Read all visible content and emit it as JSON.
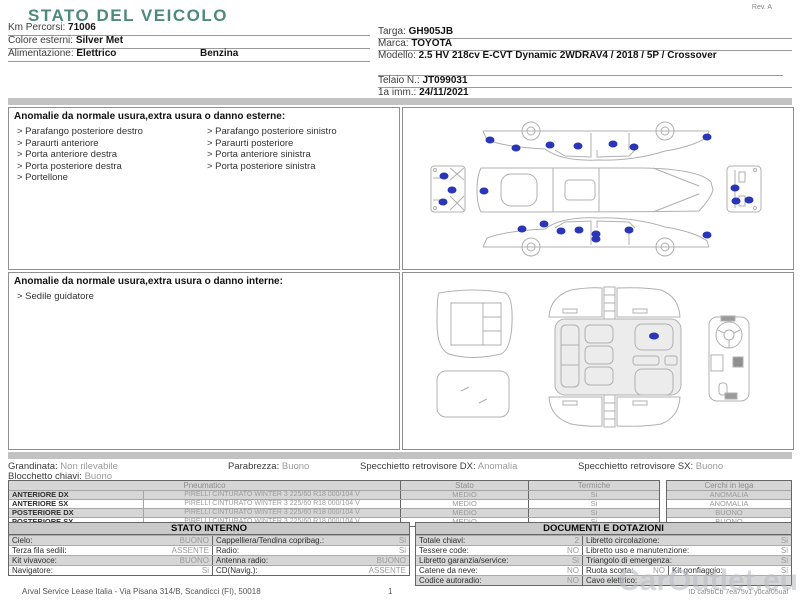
{
  "page": {
    "title": "STATO DEL VEICOLO",
    "rev": "Rev. A",
    "watermark": "CarOutlet.eu"
  },
  "colors": {
    "accent_teal": "#4d8a7a",
    "damage_marker_blue": "#2936b8",
    "stripe_gray": "#d6d6d6"
  },
  "vehicle": {
    "left": [
      {
        "label": "Km Percorsi:",
        "value": "71006"
      },
      {
        "label": "Colore esterni:",
        "value": "Silver Met"
      },
      {
        "label": "Alimentazione:",
        "value": "Elettrico",
        "value2": "Benzina"
      }
    ],
    "right": [
      {
        "label": "Targa:",
        "value": "GH905JB"
      },
      {
        "label": "Marca:",
        "value": "TOYOTA"
      },
      {
        "label": "Modello:",
        "value": "2.5 HV 218cv E-CVT Dynamic 2WDRAV4 / 2018 / 5P / Crossover"
      },
      {
        "label": "Telaio N.:",
        "value": "JT099031"
      },
      {
        "label": "1a imm.:",
        "value": "24/11/2021"
      }
    ]
  },
  "anomalies_external": {
    "header": "Anomalie da normale usura,extra usura o danno esterne:",
    "left": [
      "> Parafango posteriore destro",
      "> Paraurti anteriore",
      "> Porta anteriore destra",
      "> Porta posteriore destra",
      "> Portellone"
    ],
    "right": [
      "> Parafango posteriore sinistro",
      "> Paraurti posteriore",
      "> Porta anteriore sinistra",
      "> Porta posteriore sinistra"
    ]
  },
  "anomalies_internal": {
    "header": "Anomalie da normale usura,extra usura o danno interne:",
    "items": [
      "> Sedile guidatore"
    ]
  },
  "damage_markers": {
    "exterior_count": 22,
    "interior_count": 1
  },
  "summary": {
    "items": [
      {
        "label": "Grandinata:",
        "value": "Non rilevabile"
      },
      {
        "label": "Parabrezza:",
        "value": "Buono"
      },
      {
        "label": "Specchietto retrovisore DX:",
        "value": "Anomalia"
      },
      {
        "label": "Specchietto retrovisore SX:",
        "value": "Buono"
      }
    ],
    "row2": {
      "label": "Blocchetto chiavi:",
      "value": "Buono"
    }
  },
  "tires": {
    "header_pneumatico": "Pneumatico",
    "header_stato": "Stato",
    "header_termiche": "Termiche",
    "header_cerchi": "Cerchi in lega",
    "rows": [
      {
        "position": "ANTERIORE DX",
        "desc": "PIRELLI CINTURATO WINTER 3 225/60 R18 000/104 V",
        "stato": "MEDIO",
        "termiche": "Si",
        "cerchi": "ANOMALIA"
      },
      {
        "position": "ANTERIORE SX",
        "desc": "PIRELLI CINTURATO WINTER 3 225/60 R18 000/104 V",
        "stato": "MEDIO",
        "termiche": "Si",
        "cerchi": "ANOMALIA"
      },
      {
        "position": "POSTERIORE DX",
        "desc": "PIRELLI CINTURATO WINTER 3 225/60 R18 000/104 V",
        "stato": "MEDIO",
        "termiche": "Si",
        "cerchi": "BUONO"
      },
      {
        "position": "POSTERIORE SX",
        "desc": "PIRELLI CINTURATO WINTER 3 225/60 R18 000/104 V",
        "stato": "MEDIO",
        "termiche": "Si",
        "cerchi": "BUONO"
      }
    ]
  },
  "stato_interno": {
    "title": "STATO INTERNO",
    "rows": [
      {
        "l1": "Cielo:",
        "v1": "BUONO",
        "l2": "Cappelliera/Tendina copribag.:",
        "v2": "Si"
      },
      {
        "l1": "Terza fila sedili:",
        "v1": "ASSENTE",
        "l2": "Radio:",
        "v2": "Si"
      },
      {
        "l1": "Kit vivavoce:",
        "v1": "BUONO",
        "l2": "Antenna radio:",
        "v2": "BUONO"
      },
      {
        "l1": "Navigatore:",
        "v1": "Si",
        "l2": "CD(Navig.):",
        "v2": "ASSENTE"
      }
    ]
  },
  "documenti": {
    "title": "DOCUMENTI E DOTAZIONI",
    "rows": [
      {
        "l1": "Totale chiavi:",
        "v1": "2",
        "l2": "Libretto circolazione:",
        "v2": "Si"
      },
      {
        "l1": "Tessere code:",
        "v1": "NO",
        "l2": "Libretto uso e manutenzione:",
        "v2": "Si"
      },
      {
        "l1": "Libretto garanzia/service:",
        "v1": "Si",
        "l2": "Triangolo di emergenza:",
        "v2": "Si"
      },
      {
        "l1": "Catene da neve:",
        "v1": "NO",
        "l2": "Ruota scorta:",
        "v2": "NO",
        "l3": "Kit gonfiaggio:",
        "v3": "Si"
      },
      {
        "l1": "Codice autoradio:",
        "v1": "NO",
        "l2": "Cavo elettrico:",
        "v2": ""
      }
    ]
  },
  "footer": {
    "company": "Arval Service Lease Italia - Via Pisana 314/B, Scandicci (FI), 50018",
    "page_number": "1",
    "doc_id": "ID caf9bCb 7ea75v1 y0caf05ual"
  }
}
